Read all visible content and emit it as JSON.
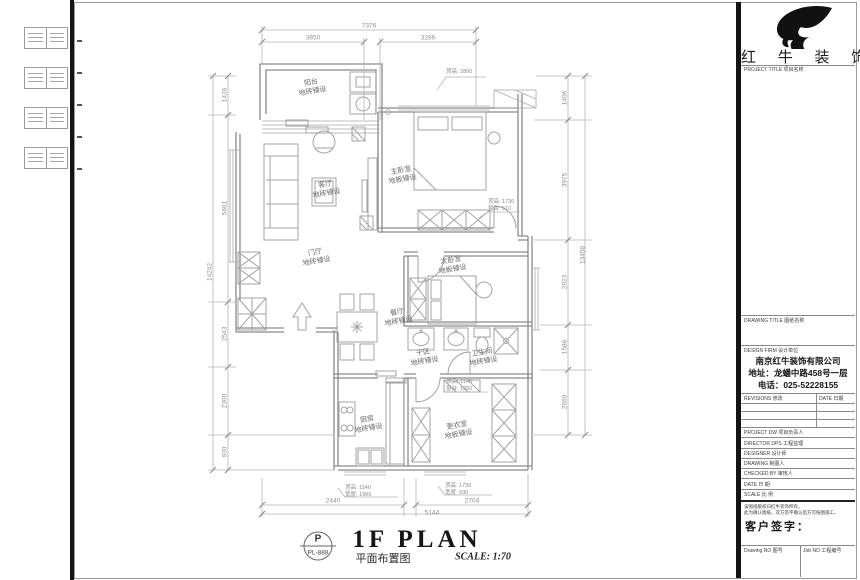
{
  "title_block": {
    "logo_name": "红 牛 装 饰",
    "project_title_label": "PROJECT TITLE 项目名称",
    "drawing_title_label": "DRAWING TITLE 图纸名称",
    "design_firm_label": "DESIGN FIRM 设计单位",
    "company_name": "南京红牛装饰有限公司",
    "company_address": "地址：龙蟠中路458号一层",
    "company_phone": "电话：025-52228155",
    "revisions_label": "REVISIONS 修改",
    "rev_date_label": "DATE 日期",
    "rows": [
      "PROJECT DW 项目负责人",
      "DIRECTOR DPS 工程监理",
      "DESIGNER 设计师",
      "DRAWING 制图人",
      "CHECKED BY 审核人",
      "DATE 日 期",
      "SCALE 比 例"
    ],
    "disclaimer_1": "该图纸版权归红牛装饰所有，",
    "disclaimer_2": "此为确认图纸，双方签字确认后方可按图施工。",
    "customer_sign_label": "客户签字：",
    "drawing_no_label": "Drawing NO 图号",
    "job_no_label": "Job NO 工程编号"
  },
  "plan": {
    "rooms": [
      {
        "name": "阳台",
        "finish": "地砖铺设"
      },
      {
        "name": "客厅",
        "finish": "地砖铺设"
      },
      {
        "name": "门厅",
        "finish": "地砖铺设"
      },
      {
        "name": "主卧室",
        "finish": "地板铺设"
      },
      {
        "name": "次卧室",
        "finish": "地板铺设"
      },
      {
        "name": "餐厅",
        "finish": "地砖铺设"
      },
      {
        "name": "干区",
        "finish": "地砖铺设"
      },
      {
        "name": "卫生间",
        "finish": "地砖铺设"
      },
      {
        "name": "厨房",
        "finish": "地砖铺设"
      },
      {
        "name": "更衣室",
        "finish": "地板铺设"
      }
    ],
    "notes": [
      {
        "l1": "顶高: 2800",
        "l2": ""
      },
      {
        "l1": "顶高: 1730",
        "l2": "窗台: 510"
      },
      {
        "l1": "顶高: 1140",
        "l2": "窗台: 1650"
      },
      {
        "l1": "顶高: 1140",
        "l2": "宽度: 1909"
      },
      {
        "l1": "顶高: 1730",
        "l2": "宽度: 930"
      }
    ],
    "dims": {
      "top_total": "7376",
      "top_left": "3850",
      "top_right": "3286",
      "left_total": "14242",
      "left_segs": [
        "1426",
        "5661",
        "2543",
        "2300",
        "930"
      ],
      "right_total": "13458",
      "right_segs": [
        "1406",
        "3975",
        "2923",
        "1586",
        "2660"
      ],
      "bottom_left": "2440",
      "bottom_right": "2704",
      "bottom_total": "5144"
    },
    "footer": {
      "badge_letter": "P",
      "badge_code": "PL-888",
      "title": "1F PLAN",
      "subtitle": "平面布置图",
      "scale": "SCALE: 1:70"
    }
  }
}
